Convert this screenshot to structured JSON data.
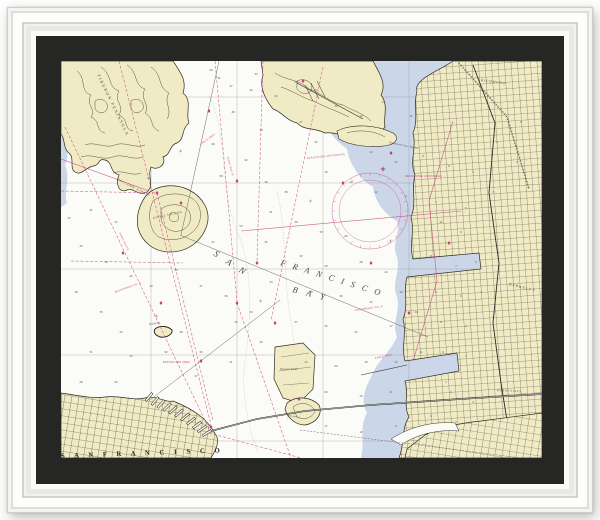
{
  "artwork_scene": {
    "frame_color": "#fafaf8",
    "mat_color": "#262625"
  },
  "chart": {
    "colors": {
      "paper": "#fbfbf7",
      "land": "#f1ebc5",
      "shallow_water": "#cbd7e8",
      "magenta": "#c33a80",
      "contour": "#43402f",
      "mat": "#262625"
    },
    "labels": [
      {
        "text": "TIBURON PENINSULA",
        "x": 36,
        "y": 14,
        "rot": 64,
        "size": 4,
        "ls": 1.6,
        "cls": "place"
      },
      {
        "text": "RACCOON STRAIT",
        "x": 56,
        "y": 119,
        "rot": 27,
        "size": 3.1,
        "ls": 0.8,
        "cls": "water"
      },
      {
        "text": "ANGEL ISLAND",
        "x": 92,
        "y": 158,
        "rot": -12,
        "size": 3,
        "ls": 0.7,
        "cls": "place"
      },
      {
        "text": "Alcatraz",
        "x": 88,
        "y": 264,
        "rot": -8,
        "size": 3,
        "ls": 0.2,
        "cls": "water"
      },
      {
        "text": "Treasure Island",
        "x": 219,
        "y": 309,
        "rot": 0,
        "size": 2.6,
        "ls": 0.1,
        "cls": "water"
      },
      {
        "text": "Yerba Buena I",
        "x": 226,
        "y": 355,
        "rot": 8,
        "size": 2.2,
        "ls": 0,
        "cls": "water"
      },
      {
        "text": "BERKELEY",
        "x": 448,
        "y": 224,
        "rot": 14,
        "size": 3.4,
        "ls": 1.2,
        "cls": "place"
      },
      {
        "text": "EMERYVILLE",
        "x": 436,
        "y": 330,
        "rot": 3,
        "size": 2.7,
        "ls": 0.8,
        "cls": "place"
      },
      {
        "text": "RICHMOND",
        "x": 420,
        "y": 20,
        "rot": 8,
        "size": 3.2,
        "ls": 1,
        "cls": "place"
      },
      {
        "text": "Richmond Inner Harbor",
        "x": 328,
        "y": 82,
        "rot": 12,
        "size": 2.7,
        "ls": 0.2,
        "cls": "water"
      },
      {
        "text": "S A N",
        "x": 152,
        "y": 194,
        "rot": 33,
        "size": 9,
        "ls": 4,
        "cls": "bay"
      },
      {
        "text": "F R A N C I S C O",
        "x": 219,
        "y": 204,
        "rot": 17,
        "size": 8.5,
        "ls": 2.6,
        "cls": "bay"
      },
      {
        "text": "B A Y",
        "x": 231,
        "y": 231,
        "rot": 14,
        "size": 8.5,
        "ls": 3.5,
        "cls": "bay"
      },
      {
        "text": "S A N   F R A N C I S C O",
        "x": 0,
        "y": 397,
        "rot": -2,
        "size": 6.8,
        "ls": 4,
        "cls": "city"
      },
      {
        "text": "EXPLOSIVES ANCHORAGE",
        "x": 246,
        "y": 98,
        "rot": -6,
        "size": 2.5,
        "ls": 0.3,
        "cls": "note"
      },
      {
        "text": "ANCHORAGE NO. 9",
        "x": 54,
        "y": 232,
        "rot": -20,
        "size": 2.5,
        "ls": 0.3,
        "cls": "note"
      },
      {
        "text": "ANCHORAGE NO. 8",
        "x": 294,
        "y": 250,
        "rot": -8,
        "size": 2.5,
        "ls": 0.3,
        "cls": "note"
      },
      {
        "text": "CABLE AREA",
        "x": 140,
        "y": 84,
        "rot": -36,
        "size": 2.4,
        "ls": 0.3,
        "cls": "note"
      },
      {
        "text": "CABLE AREA",
        "x": 314,
        "y": 298,
        "rot": -12,
        "size": 2.4,
        "ls": 0.3,
        "cls": "note"
      },
      {
        "text": "RESTRICTED AREA",
        "x": 102,
        "y": 302,
        "rot": 0,
        "size": 2.4,
        "ls": 0.3,
        "cls": "note"
      },
      {
        "text": "DESIGNATED ANCHORAGE",
        "x": 344,
        "y": 116,
        "rot": 0,
        "size": 2.4,
        "ls": 0.3,
        "cls": "note"
      },
      {
        "text": "FERRY ROUTE",
        "x": 58,
        "y": 172,
        "rot": 64,
        "size": 2.3,
        "ls": 0.3,
        "cls": "note"
      },
      {
        "text": "FERRY ROUTE",
        "x": 166,
        "y": 96,
        "rot": 75,
        "size": 2.3,
        "ls": 0.3,
        "cls": "note"
      }
    ],
    "soundings": [
      [
        158,
        18,
        51
      ],
      [
        190,
        30,
        44
      ],
      [
        172,
        52,
        48
      ],
      [
        200,
        70,
        39
      ],
      [
        152,
        84,
        46
      ],
      [
        185,
        100,
        42
      ],
      [
        160,
        116,
        58
      ],
      [
        205,
        122,
        36
      ],
      [
        8,
        158,
        33
      ],
      [
        30,
        150,
        41
      ],
      [
        55,
        162,
        37
      ],
      [
        20,
        186,
        44
      ],
      [
        45,
        202,
        39
      ],
      [
        70,
        216,
        42
      ],
      [
        15,
        232,
        38
      ],
      [
        40,
        252,
        35
      ],
      [
        88,
        118,
        82
      ],
      [
        115,
        210,
        43
      ],
      [
        140,
        226,
        37
      ],
      [
        60,
        272,
        33
      ],
      [
        95,
        256,
        36
      ],
      [
        120,
        272,
        38
      ],
      [
        30,
        292,
        31
      ],
      [
        70,
        296,
        34
      ],
      [
        105,
        292,
        32
      ],
      [
        140,
        292,
        30
      ],
      [
        20,
        322,
        28
      ],
      [
        55,
        322,
        29
      ],
      [
        135,
        316,
        27
      ],
      [
        170,
        302,
        31
      ],
      [
        175,
        262,
        35
      ],
      [
        200,
        282,
        30
      ],
      [
        165,
        236,
        39
      ],
      [
        190,
        252,
        34
      ],
      [
        210,
        222,
        33
      ],
      [
        205,
        182,
        45
      ],
      [
        180,
        166,
        52
      ],
      [
        152,
        182,
        47
      ],
      [
        210,
        152,
        41
      ],
      [
        225,
        132,
        38
      ],
      [
        90,
        226,
        40
      ],
      [
        150,
        10,
        40
      ],
      [
        170,
        26,
        37
      ],
      [
        195,
        14,
        33
      ],
      [
        215,
        36,
        29
      ],
      [
        235,
        22,
        26
      ],
      [
        235,
        162,
        36
      ],
      [
        260,
        172,
        33
      ],
      [
        285,
        176,
        30
      ],
      [
        240,
        196,
        32
      ],
      [
        265,
        206,
        29
      ],
      [
        300,
        202,
        28
      ],
      [
        325,
        212,
        24
      ],
      [
        250,
        232,
        28
      ],
      [
        280,
        236,
        26
      ],
      [
        310,
        242,
        22
      ],
      [
        340,
        232,
        19
      ],
      [
        235,
        262,
        27
      ],
      [
        265,
        266,
        25
      ],
      [
        295,
        272,
        21
      ],
      [
        330,
        266,
        17
      ],
      [
        355,
        252,
        14
      ],
      [
        245,
        302,
        24
      ],
      [
        275,
        306,
        22
      ],
      [
        305,
        302,
        18
      ],
      [
        335,
        302,
        13
      ],
      [
        360,
        292,
        11
      ],
      [
        265,
        332,
        20
      ],
      [
        300,
        336,
        15
      ],
      [
        330,
        332,
        11
      ],
      [
        385,
        322,
        7
      ],
      [
        265,
        366,
        17
      ],
      [
        300,
        372,
        12
      ],
      [
        335,
        366,
        8
      ],
      [
        380,
        162,
        12
      ],
      [
        400,
        172,
        9
      ],
      [
        370,
        196,
        11
      ],
      [
        395,
        206,
        7
      ],
      [
        415,
        202,
        5
      ],
      [
        375,
        232,
        9
      ],
      [
        400,
        236,
        6
      ],
      [
        420,
        232,
        3
      ],
      [
        380,
        262,
        8
      ],
      [
        405,
        266,
        4
      ],
      [
        382,
        292,
        6
      ],
      [
        405,
        296,
        3
      ],
      [
        390,
        332,
        4
      ],
      [
        412,
        342,
        2
      ],
      [
        370,
        356,
        6
      ],
      [
        395,
        362,
        3
      ],
      [
        255,
        30,
        24
      ],
      [
        275,
        46,
        20
      ],
      [
        300,
        56,
        16
      ],
      [
        322,
        42,
        13
      ],
      [
        350,
        56,
        11
      ],
      [
        310,
        92,
        14
      ],
      [
        335,
        102,
        10
      ],
      [
        362,
        96,
        8
      ],
      [
        388,
        106,
        6
      ],
      [
        412,
        112,
        4
      ],
      [
        290,
        122,
        18
      ],
      [
        315,
        132,
        12
      ],
      [
        345,
        136,
        9
      ],
      [
        375,
        142,
        7
      ],
      [
        405,
        148,
        5
      ],
      [
        432,
        132,
        3
      ],
      [
        255,
        82,
        22
      ],
      [
        265,
        112,
        19
      ],
      [
        240,
        62,
        27
      ],
      [
        436,
        82,
        4
      ],
      [
        456,
        102,
        3
      ],
      [
        460,
        62,
        5
      ]
    ],
    "routes": [
      [
        4,
        66,
        148,
        368
      ],
      [
        58,
        0,
        150,
        364
      ],
      [
        96,
        132,
        152,
        360
      ],
      [
        154,
        0,
        176,
        240
      ],
      [
        202,
        0,
        196,
        200
      ],
      [
        262,
        6,
        210,
        260
      ],
      [
        148,
        372,
        240,
        397
      ],
      [
        10,
        200,
        122,
        202
      ],
      [
        176,
        242,
        230,
        397
      ],
      [
        0,
        130,
        96,
        132
      ]
    ],
    "magenta_lines": [
      [
        180,
        170,
        400,
        150
      ],
      [
        0,
        98,
        88,
        130
      ],
      [
        392,
        60,
        368,
        140
      ],
      [
        368,
        140,
        376,
        220
      ],
      [
        376,
        220,
        352,
        300
      ]
    ],
    "dark_lines": [
      [
        119,
        174,
        367,
        276,
        0
      ],
      [
        89,
        339,
        219,
        239,
        0
      ],
      [
        239,
        369,
        460,
        397,
        1
      ],
      [
        158,
        0,
        120,
        174,
        0
      ]
    ],
    "graticule": {
      "vertical_x": [
        90,
        176,
        262,
        348,
        434
      ],
      "horizontal_y": [
        36,
        122,
        208,
        294,
        380
      ]
    },
    "buoys": [
      [
        148,
        50
      ],
      [
        176,
        120
      ],
      [
        120,
        142
      ],
      [
        62,
        192
      ],
      [
        100,
        242
      ],
      [
        140,
        300
      ],
      [
        176,
        242
      ],
      [
        196,
        202
      ],
      [
        214,
        262
      ],
      [
        238,
        338
      ],
      [
        310,
        202
      ],
      [
        348,
        252
      ],
      [
        388,
        182
      ],
      [
        282,
        122
      ],
      [
        330,
        92
      ],
      [
        150,
        366
      ],
      [
        96,
        132
      ],
      [
        242,
        20
      ]
    ],
    "piers": [
      [
        88,
        336,
        40
      ],
      [
        94,
        340,
        42
      ],
      [
        100,
        343,
        44
      ],
      [
        106,
        346,
        46
      ],
      [
        112,
        349,
        47
      ],
      [
        118,
        352,
        48
      ],
      [
        124,
        356,
        50
      ],
      [
        130,
        360,
        52
      ],
      [
        136,
        364,
        54
      ],
      [
        141,
        368,
        56
      ],
      [
        146,
        372,
        58
      ]
    ],
    "compass": {
      "cx": 309,
      "cy": 150,
      "r_outer": 38,
      "r_inner": 31,
      "star_x": 322,
      "star_y": 108
    }
  }
}
